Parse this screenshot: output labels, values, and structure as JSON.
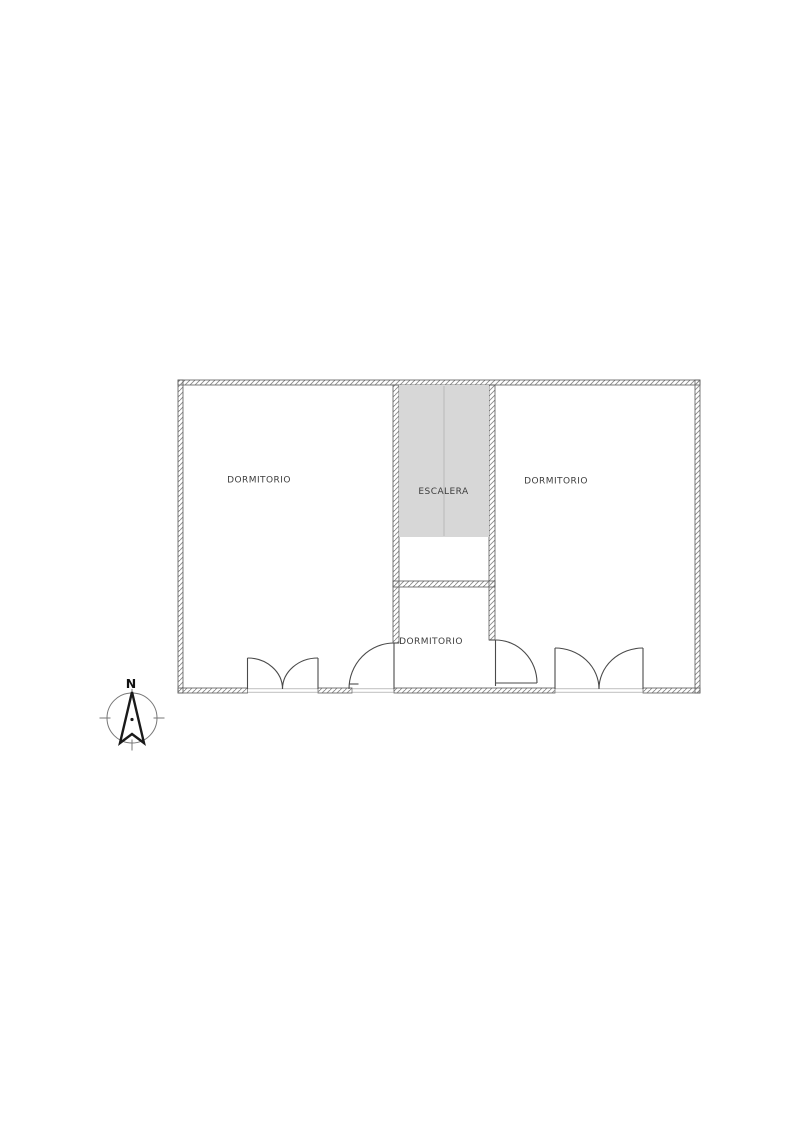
{
  "floor_plan": {
    "labels": {
      "room_left": "DORMITORIO",
      "room_right": "DORMITORIO",
      "room_bottom": "DORMITORIO",
      "stairs": "ESCALERA"
    },
    "compass": {
      "north_label": "N"
    },
    "colors": {
      "background": "#ffffff",
      "wall_outline": "#5a5a5a",
      "wall_hatch": "#8a8a8a",
      "stair_fill": "#d7d7d7",
      "stair_center_line": "#c2c2c2",
      "door_line": "#4a4a4a",
      "label_text": "#3d3d3d",
      "compass_line": "#777777",
      "needle_outline": "#1a1a1a"
    }
  }
}
